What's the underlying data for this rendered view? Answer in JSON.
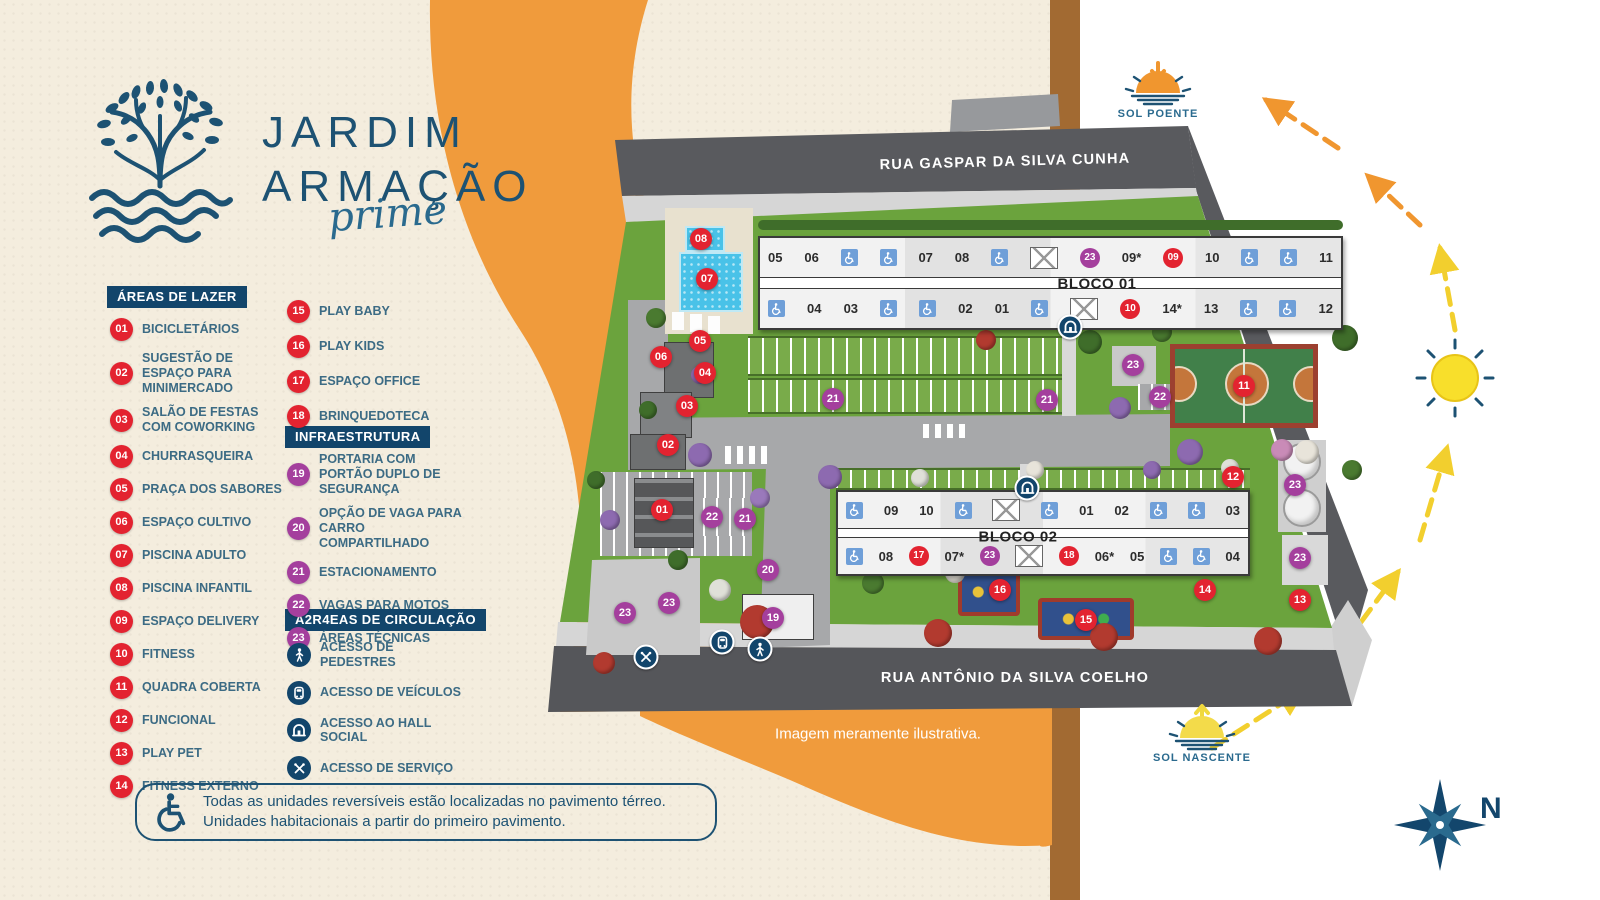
{
  "logo": {
    "line1": "JARDIM",
    "line2": "ARMAÇÃO",
    "script": "prime"
  },
  "legend": {
    "lazer": {
      "header": "ÁREAS DE LAZER",
      "items": [
        {
          "n": "01",
          "c": "red",
          "label": "BICICLETÁRIOS"
        },
        {
          "n": "02",
          "c": "red",
          "label": "SUGESTÃO DE ESPAÇO PARA MINIMERCADO"
        },
        {
          "n": "03",
          "c": "red",
          "label": "SALÃO DE FESTAS COM COWORKING"
        },
        {
          "n": "04",
          "c": "red",
          "label": "CHURRASQUEIRA"
        },
        {
          "n": "05",
          "c": "red",
          "label": "PRAÇA DOS SABORES"
        },
        {
          "n": "06",
          "c": "red",
          "label": "ESPAÇO CULTIVO"
        },
        {
          "n": "07",
          "c": "red",
          "label": "PISCINA ADULTO"
        },
        {
          "n": "08",
          "c": "red",
          "label": "PISCINA INFANTIL"
        },
        {
          "n": "09",
          "c": "red",
          "label": "ESPAÇO DELIVERY"
        },
        {
          "n": "10",
          "c": "red",
          "label": "FITNESS"
        },
        {
          "n": "11",
          "c": "red",
          "label": "QUADRA COBERTA"
        },
        {
          "n": "12",
          "c": "red",
          "label": "FUNCIONAL"
        },
        {
          "n": "13",
          "c": "red",
          "label": "PLAY PET"
        },
        {
          "n": "14",
          "c": "red",
          "label": "FITNESS EXTERNO"
        }
      ]
    },
    "lazer2": {
      "items": [
        {
          "n": "15",
          "c": "red",
          "label": "PLAY BABY"
        },
        {
          "n": "16",
          "c": "red",
          "label": "PLAY KIDS"
        },
        {
          "n": "17",
          "c": "red",
          "label": "ESPAÇO OFFICE"
        },
        {
          "n": "18",
          "c": "red",
          "label": "BRINQUEDOTECA"
        }
      ]
    },
    "infra": {
      "header": "INFRAESTRUTURA",
      "items": [
        {
          "n": "19",
          "c": "purple",
          "label": "PORTARIA COM PORTÃO DUPLO DE SEGURANÇA"
        },
        {
          "n": "20",
          "c": "purple",
          "label": "OPÇÃO DE VAGA PARA CARRO COMPARTILHADO"
        },
        {
          "n": "21",
          "c": "purple",
          "label": "ESTACIONAMENTO"
        },
        {
          "n": "22",
          "c": "purple",
          "label": "VAGAS PARA MOTOS"
        },
        {
          "n": "23",
          "c": "purple",
          "label": "ÁREAS TÉCNICAS"
        }
      ]
    },
    "circulacao": {
      "header": "Á2R4EAS DE CIRCULAÇÃO",
      "items": [
        {
          "icon": "pedestrian-icon",
          "label": "ACESSO DE PEDESTRES"
        },
        {
          "icon": "vehicle-icon",
          "label": "ACESSO DE VEÍCULOS"
        },
        {
          "icon": "hall-icon",
          "label": "ACESSO AO HALL SOCIAL"
        },
        {
          "icon": "service-icon",
          "label": "ACESSO DE SERVIÇO"
        }
      ]
    }
  },
  "note": {
    "line1": "Todas as unidades reversíveis estão localizadas no pavimento térreo.",
    "line2": "Unidades habitacionais a partir do primeiro pavimento."
  },
  "map": {
    "street_top": "RUA GASPAR DA SILVA CUNHA",
    "street_bottom": "RUA ANTÔNIO DA SILVA COELHO",
    "disclaimer": "Imagem meramente ilustrativa.",
    "bloco1": {
      "label": "BLOCO 01",
      "top": [
        {
          "t": "num",
          "v": "05"
        },
        {
          "t": "num",
          "v": "06"
        },
        {
          "t": "acc"
        },
        {
          "t": "acc"
        },
        {
          "t": "num",
          "v": "07"
        },
        {
          "t": "num",
          "v": "08"
        },
        {
          "t": "acc"
        },
        {
          "t": "stair"
        },
        {
          "t": "badge",
          "v": "23",
          "c": "purple"
        },
        {
          "t": "num",
          "v": "09*"
        },
        {
          "t": "badge",
          "v": "09",
          "c": "red"
        },
        {
          "t": "num",
          "v": "10"
        },
        {
          "t": "acc"
        },
        {
          "t": "acc"
        },
        {
          "t": "num",
          "v": "11"
        }
      ],
      "bottom": [
        {
          "t": "acc"
        },
        {
          "t": "num",
          "v": "04"
        },
        {
          "t": "num",
          "v": "03"
        },
        {
          "t": "acc"
        },
        {
          "t": "acc"
        },
        {
          "t": "num",
          "v": "02"
        },
        {
          "t": "num",
          "v": "01"
        },
        {
          "t": "acc"
        },
        {
          "t": "stair"
        },
        {
          "t": "badge",
          "v": "10",
          "c": "red"
        },
        {
          "t": "num",
          "v": "14*"
        },
        {
          "t": "num",
          "v": "13"
        },
        {
          "t": "acc"
        },
        {
          "t": "acc"
        },
        {
          "t": "num",
          "v": "12"
        }
      ]
    },
    "bloco2": {
      "label": "BLOCO 02",
      "top": [
        {
          "t": "acc"
        },
        {
          "t": "num",
          "v": "09"
        },
        {
          "t": "num",
          "v": "10"
        },
        {
          "t": "acc"
        },
        {
          "t": "stair"
        },
        {
          "t": "acc"
        },
        {
          "t": "num",
          "v": "01"
        },
        {
          "t": "num",
          "v": "02"
        },
        {
          "t": "acc"
        },
        {
          "t": "acc"
        },
        {
          "t": "num",
          "v": "03"
        }
      ],
      "bottom": [
        {
          "t": "acc"
        },
        {
          "t": "num",
          "v": "08"
        },
        {
          "t": "badge",
          "v": "17",
          "c": "red"
        },
        {
          "t": "num",
          "v": "07*"
        },
        {
          "t": "badge",
          "v": "23",
          "c": "purple"
        },
        {
          "t": "stair"
        },
        {
          "t": "badge",
          "v": "18",
          "c": "red"
        },
        {
          "t": "num",
          "v": "06*"
        },
        {
          "t": "num",
          "v": "05"
        },
        {
          "t": "acc"
        },
        {
          "t": "acc"
        },
        {
          "t": "num",
          "v": "04"
        }
      ]
    },
    "markers": [
      {
        "n": "08",
        "c": "red",
        "x": 701,
        "y": 239
      },
      {
        "n": "07",
        "c": "red",
        "x": 707,
        "y": 279
      },
      {
        "n": "05",
        "c": "red",
        "x": 700,
        "y": 341
      },
      {
        "n": "06",
        "c": "red",
        "x": 661,
        "y": 357
      },
      {
        "n": "04",
        "c": "red",
        "x": 705,
        "y": 373
      },
      {
        "n": "03",
        "c": "red",
        "x": 687,
        "y": 406
      },
      {
        "n": "02",
        "c": "red",
        "x": 668,
        "y": 445
      },
      {
        "n": "01",
        "c": "red",
        "x": 662,
        "y": 510
      },
      {
        "n": "11",
        "c": "red",
        "x": 1244,
        "y": 386
      },
      {
        "n": "12",
        "c": "red",
        "x": 1233,
        "y": 477
      },
      {
        "n": "13",
        "c": "red",
        "x": 1300,
        "y": 600
      },
      {
        "n": "14",
        "c": "red",
        "x": 1205,
        "y": 590
      },
      {
        "n": "15",
        "c": "red",
        "x": 1086,
        "y": 620
      },
      {
        "n": "16",
        "c": "red",
        "x": 1000,
        "y": 590
      },
      {
        "n": "21",
        "c": "purple",
        "x": 833,
        "y": 399
      },
      {
        "n": "21",
        "c": "purple",
        "x": 1047,
        "y": 400
      },
      {
        "n": "23",
        "c": "purple",
        "x": 1133,
        "y": 365
      },
      {
        "n": "22",
        "c": "purple",
        "x": 1160,
        "y": 397
      },
      {
        "n": "22",
        "c": "purple",
        "x": 712,
        "y": 517
      },
      {
        "n": "21",
        "c": "purple",
        "x": 745,
        "y": 519
      },
      {
        "n": "20",
        "c": "purple",
        "x": 768,
        "y": 570
      },
      {
        "n": "19",
        "c": "purple",
        "x": 773,
        "y": 618
      },
      {
        "n": "23",
        "c": "purple",
        "x": 625,
        "y": 613
      },
      {
        "n": "23",
        "c": "purple",
        "x": 669,
        "y": 603
      },
      {
        "n": "23",
        "c": "purple",
        "x": 1295,
        "y": 485
      },
      {
        "n": "23",
        "c": "purple",
        "x": 1300,
        "y": 558
      }
    ],
    "icons": [
      {
        "name": "hall-icon",
        "x": 1070,
        "y": 327
      },
      {
        "name": "hall-icon",
        "x": 1027,
        "y": 488
      },
      {
        "name": "vehicle-icon",
        "x": 722,
        "y": 642
      },
      {
        "name": "pedestrian-icon",
        "x": 760,
        "y": 649
      },
      {
        "name": "service-icon",
        "x": 646,
        "y": 657
      }
    ]
  },
  "sun": {
    "poente": "SOL POENTE",
    "nascente": "SOL NASCENTE"
  },
  "compass": {
    "label": "N"
  },
  "colors": {
    "navy": "#12456b",
    "cream": "#f4edde",
    "orange": "#f09b3c",
    "red_badge": "#e32330",
    "purple_badge": "#a43f9d",
    "street": "#595a5e",
    "lawn": "#6ba33d",
    "pool": "#49c2e8"
  }
}
